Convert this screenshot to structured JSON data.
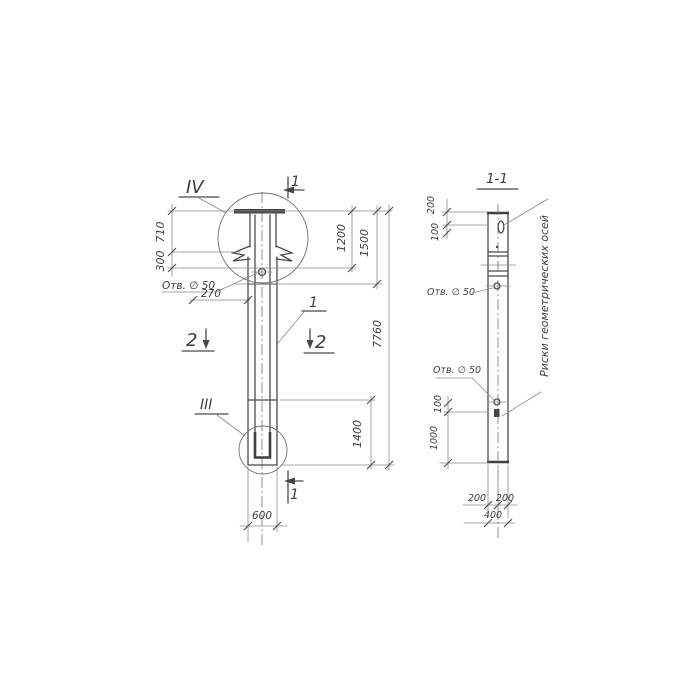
{
  "main_view": {
    "detail_marker_top": "IV",
    "detail_marker_bottom": "III",
    "section_mark_top": "1",
    "section_mark_bottom": "1",
    "section_mark_2_left": "2",
    "section_mark_2_right": "2",
    "part_label": "1",
    "hole_label": "Отв. ∅ 50",
    "dims": {
      "d710": "710",
      "d300": "300",
      "d270": "270",
      "d1200": "1200",
      "d1500": "1500",
      "d7760": "7760",
      "d1400": "1400",
      "d600": "600"
    }
  },
  "section_view": {
    "title": "1-1",
    "hole_label_top": "Отв. ∅ 50",
    "hole_label_bottom": "Отв. ∅ 50",
    "axes_note": "Риски геометрических осей",
    "dims": {
      "d200_top": "200",
      "d100_top": "100",
      "d100_bottom": "100",
      "d1000": "1000",
      "d200_left": "200",
      "d200_right": "200",
      "d400": "400"
    }
  },
  "style": {
    "ink_color": "#4a4a4a",
    "paper_color": "#ffffff"
  }
}
